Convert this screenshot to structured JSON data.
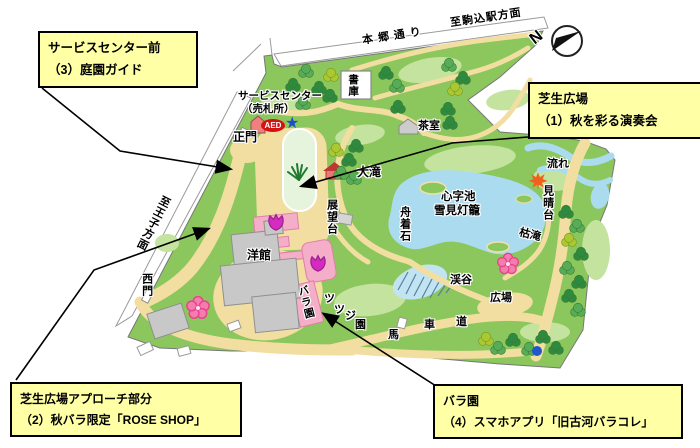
{
  "callouts": {
    "service_center": {
      "line1": "サービスセンター前",
      "line2": "（3）庭園ガイド"
    },
    "lawn": {
      "line1": "芝生広場",
      "line2": "（1）秋を彩る演奏会"
    },
    "approach": {
      "line1": "芝生広場アプローチ部分",
      "line2": "（2）秋バラ限定「ROSE SHOP」"
    },
    "rose": {
      "line1": "バラ園",
      "line2": "（4）スマホアプリ「旧古河バラコレ」"
    }
  },
  "map": {
    "roads": {
      "hongo": "本郷通り",
      "to_komagome": "至駒込駅方面",
      "to_oji": "至王子方面"
    },
    "compass": {
      "n": "N"
    },
    "icons": {
      "star": "★"
    },
    "labels": {
      "service_center_1": "サービスセンター",
      "service_center_2": "（売札所）",
      "aed": "AED",
      "main_gate": "正門",
      "shoko": "書庫",
      "chashitsu": "茶室",
      "otaki": "大滝",
      "shinjiike": "心字池",
      "yukimi_lantern": "雪見灯籠",
      "funatsuki_ishi": "舟着石",
      "tenbodai": "展望台",
      "yokan": "洋館",
      "west_gate": "西門",
      "rose_garden": "バラ園",
      "keikoku": "渓谷",
      "hiroba": "広場",
      "karetaki": "枯滝",
      "miharashidai": "見晴台",
      "nagare": "流れ"
    },
    "spread": {
      "bashamichi": [
        "馬",
        "車",
        "道"
      ],
      "tsutsujien": [
        "ツ",
        "ツ",
        "ジ",
        "園"
      ]
    }
  },
  "colors": {
    "garden_green": "#8cc75d",
    "light_green": "#c3e39f",
    "pond_blue": "#abdbef",
    "path_tan": "#f3dea2",
    "building_gray": "#c8c8c8",
    "rose_pink": "#f5aec8",
    "callout_yellow": "#ffffa6",
    "aed_red": "#d61111",
    "star_blue": "#1b50c8"
  }
}
